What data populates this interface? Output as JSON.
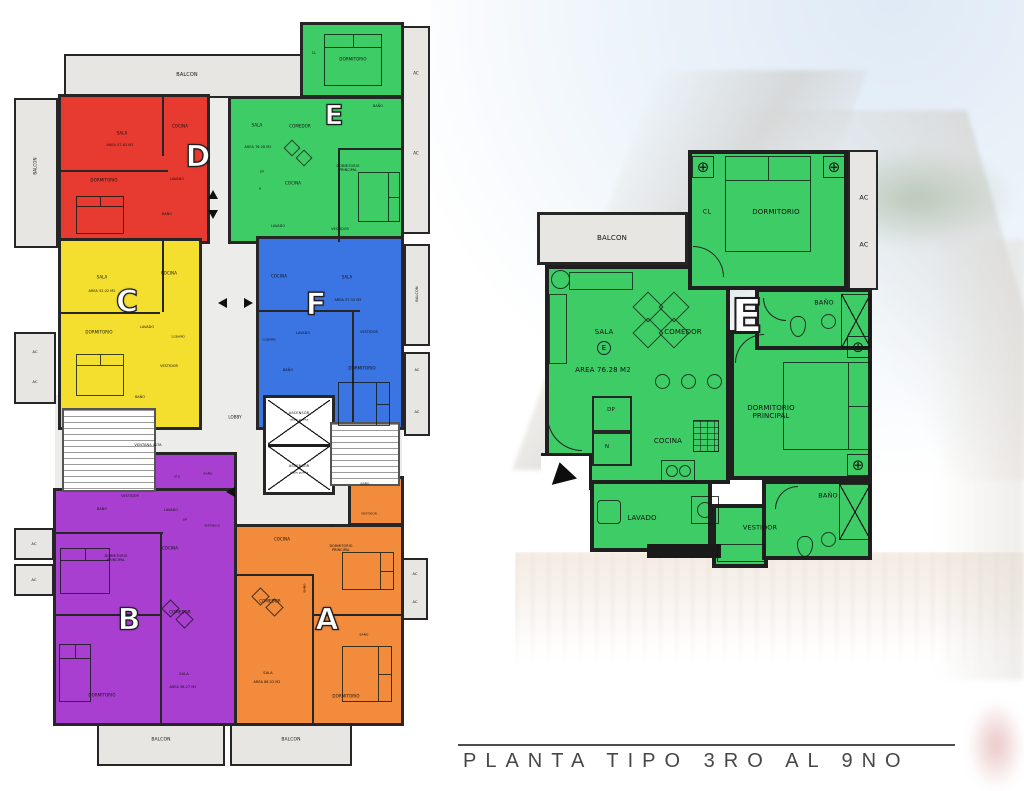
{
  "title_block": {
    "text": "PLANTA TIPO 3RO AL 9NO"
  },
  "colors": {
    "unit_a": "#F28B3B",
    "unit_b": "#A93FD1",
    "unit_c": "#F4DF2E",
    "unit_d": "#E73B31",
    "unit_e": "#3ECC66",
    "unit_f": "#3B74E3"
  },
  "units": [
    {
      "letter": "A",
      "area_label": "AREA 86.03 M2",
      "color": "#F28B3B"
    },
    {
      "letter": "B",
      "area_label": "AREA 98.27 M2",
      "color": "#A93FD1"
    },
    {
      "letter": "C",
      "area_label": "AREA 52.02 M2",
      "color": "#F4DF2E"
    },
    {
      "letter": "D",
      "area_label": "AREA 57.83 M2",
      "color": "#E73B31"
    },
    {
      "letter": "E",
      "area_label": "AREA 76.28 M2",
      "color": "#3ECC66"
    },
    {
      "letter": "F",
      "area_label": "AREA 57.33 M2",
      "color": "#3B74E3"
    }
  ],
  "overview_plan": {
    "letters": [
      {
        "t": "D",
        "x": 186,
        "y": 143,
        "fs": 30,
        "name": "unit-letter-d"
      },
      {
        "t": "E",
        "x": 322,
        "y": 101,
        "fs": 28,
        "name": "unit-letter-e"
      },
      {
        "t": "C",
        "x": 115,
        "y": 288,
        "fs": 30,
        "name": "unit-letter-c"
      },
      {
        "t": "F",
        "x": 304,
        "y": 291,
        "fs": 30,
        "name": "unit-letter-f"
      },
      {
        "t": "B",
        "x": 117,
        "y": 606,
        "fs": 30,
        "name": "unit-letter-b"
      },
      {
        "t": "A",
        "x": 315,
        "y": 606,
        "fs": 30,
        "name": "unit-letter-a"
      }
    ],
    "labels": [
      {
        "t": "BALCON",
        "x": 175,
        "y": 62,
        "fs": 5
      },
      {
        "t": "AC",
        "x": 404,
        "y": 60,
        "fs": 4
      },
      {
        "t": "AC",
        "x": 404,
        "y": 140,
        "fs": 4
      },
      {
        "t": "BALCON",
        "x": 24,
        "y": 152,
        "fs": 4,
        "rot": -90
      },
      {
        "t": "AC",
        "x": 23,
        "y": 338,
        "fs": 3.8
      },
      {
        "t": "AC",
        "x": 23,
        "y": 368,
        "fs": 3.8
      },
      {
        "t": "BALCON",
        "x": 405,
        "y": 280,
        "fs": 3.6,
        "rot": -90
      },
      {
        "t": "AC",
        "x": 405,
        "y": 356,
        "fs": 3.6
      },
      {
        "t": "AC",
        "x": 405,
        "y": 398,
        "fs": 3.6
      },
      {
        "t": "AC",
        "x": 22,
        "y": 530,
        "fs": 3.8
      },
      {
        "t": "AC",
        "x": 22,
        "y": 566,
        "fs": 3.8
      },
      {
        "t": "AC",
        "x": 403,
        "y": 560,
        "fs": 3.6
      },
      {
        "t": "AC",
        "x": 403,
        "y": 588,
        "fs": 3.6
      },
      {
        "t": "LOBBY",
        "x": 223,
        "y": 404,
        "fs": 4
      },
      {
        "t": "VENTANA ALTA",
        "x": 136,
        "y": 431,
        "fs": 3.6
      },
      {
        "t": "ASCENSOR",
        "x": 287,
        "y": 399,
        "fs": 3.6
      },
      {
        "t": "doble puerta",
        "x": 287,
        "y": 406,
        "fs": 2.8
      },
      {
        "t": "ASCENSOR",
        "x": 287,
        "y": 452,
        "fs": 3.6
      },
      {
        "t": "doble puerta",
        "x": 287,
        "y": 459,
        "fs": 2.8
      },
      {
        "t": "BALCON",
        "x": 149,
        "y": 726,
        "fs": 4.5
      },
      {
        "t": "BALCON",
        "x": 279,
        "y": 726,
        "fs": 4.5
      },
      {
        "t": "SALA",
        "x": 110,
        "y": 120,
        "fs": 4
      },
      {
        "t": "AREA 57.83 M2",
        "x": 108,
        "y": 132,
        "fs": 3.4
      },
      {
        "t": "COCINA",
        "x": 168,
        "y": 113,
        "fs": 4
      },
      {
        "t": "DORMITORIO",
        "x": 92,
        "y": 167,
        "fs": 4
      },
      {
        "t": "LAVADO",
        "x": 165,
        "y": 166,
        "fs": 3.4
      },
      {
        "t": "BAÑO",
        "x": 155,
        "y": 201,
        "fs": 3.4
      },
      {
        "t": "DORMITORIO",
        "x": 341,
        "y": 46,
        "fs": 4
      },
      {
        "t": "CL",
        "x": 302,
        "y": 40,
        "fs": 3.4
      },
      {
        "t": "SALA",
        "x": 245,
        "y": 112,
        "fs": 4
      },
      {
        "t": "COMEDOR",
        "x": 288,
        "y": 113,
        "fs": 4
      },
      {
        "t": "AREA 76.28 M2",
        "x": 246,
        "y": 134,
        "fs": 3.4
      },
      {
        "t": "BAÑO",
        "x": 366,
        "y": 93,
        "fs": 3.4
      },
      {
        "t": "DORMITORIO\nPRINCIPAL",
        "x": 336,
        "y": 155,
        "fs": 3.4
      },
      {
        "t": "COCINA",
        "x": 281,
        "y": 170,
        "fs": 4
      },
      {
        "t": "DP",
        "x": 250,
        "y": 158,
        "fs": 3
      },
      {
        "t": "N",
        "x": 248,
        "y": 175,
        "fs": 3
      },
      {
        "t": "LAVADO",
        "x": 266,
        "y": 213,
        "fs": 3.4
      },
      {
        "t": "VESTIDOR",
        "x": 328,
        "y": 216,
        "fs": 3.4
      },
      {
        "t": "SALA",
        "x": 90,
        "y": 264,
        "fs": 4
      },
      {
        "t": "AREA 52.02 M2",
        "x": 90,
        "y": 278,
        "fs": 3.4
      },
      {
        "t": "COCINA",
        "x": 157,
        "y": 260,
        "fs": 4
      },
      {
        "t": "DORMITORIO",
        "x": 87,
        "y": 319,
        "fs": 4
      },
      {
        "t": "LAVADO",
        "x": 135,
        "y": 314,
        "fs": 3.4
      },
      {
        "t": "1/2BAÑO",
        "x": 166,
        "y": 323,
        "fs": 3
      },
      {
        "t": "VESTIDOR",
        "x": 157,
        "y": 353,
        "fs": 3.4
      },
      {
        "t": "BAÑO",
        "x": 128,
        "y": 384,
        "fs": 3.4
      },
      {
        "t": "COCINA",
        "x": 267,
        "y": 263,
        "fs": 4
      },
      {
        "t": "SALA",
        "x": 335,
        "y": 264,
        "fs": 4
      },
      {
        "t": "AREA 57.33 M2",
        "x": 336,
        "y": 287,
        "fs": 3.4
      },
      {
        "t": "LAVADO",
        "x": 291,
        "y": 320,
        "fs": 3.4
      },
      {
        "t": "1/2BAÑO",
        "x": 257,
        "y": 326,
        "fs": 3
      },
      {
        "t": "BAÑO",
        "x": 276,
        "y": 357,
        "fs": 3.4
      },
      {
        "t": "VESTIDOR",
        "x": 357,
        "y": 319,
        "fs": 3.4
      },
      {
        "t": "DORMITORIO",
        "x": 350,
        "y": 355,
        "fs": 4
      },
      {
        "t": "VESTIDOR",
        "x": 118,
        "y": 483,
        "fs": 3.4
      },
      {
        "t": "BAÑO",
        "x": 90,
        "y": 496,
        "fs": 3.4
      },
      {
        "t": "UTIL",
        "x": 165,
        "y": 463,
        "fs": 3
      },
      {
        "t": "BAÑO",
        "x": 196,
        "y": 460,
        "fs": 3
      },
      {
        "t": "LAVADO",
        "x": 159,
        "y": 497,
        "fs": 3.4
      },
      {
        "t": "DP",
        "x": 173,
        "y": 506,
        "fs": 3
      },
      {
        "t": "VESTIBULO",
        "x": 200,
        "y": 512,
        "fs": 2.8
      },
      {
        "t": "COCINA",
        "x": 158,
        "y": 535,
        "fs": 4
      },
      {
        "t": "DORMITORIO\nPRINCIPAL",
        "x": 104,
        "y": 545,
        "fs": 3.4
      },
      {
        "t": "COMEDOR",
        "x": 168,
        "y": 599,
        "fs": 4
      },
      {
        "t": "SALA",
        "x": 172,
        "y": 660,
        "fs": 3.6
      },
      {
        "t": "AREA 98.27 M2",
        "x": 171,
        "y": 674,
        "fs": 3.4
      },
      {
        "t": "DORMITORIO",
        "x": 90,
        "y": 682,
        "fs": 4
      },
      {
        "t": "BAÑO",
        "x": 353,
        "y": 470,
        "fs": 3
      },
      {
        "t": "VESTIDOR",
        "x": 357,
        "y": 500,
        "fs": 3
      },
      {
        "t": "COCINA",
        "x": 270,
        "y": 526,
        "fs": 4
      },
      {
        "t": "CL",
        "x": 320,
        "y": 512,
        "fs": 3
      },
      {
        "t": "DORMITORIO\nPRINCIPAL",
        "x": 329,
        "y": 535,
        "fs": 3.4
      },
      {
        "t": "BAÑO",
        "x": 293,
        "y": 574,
        "fs": 3,
        "rot": -90
      },
      {
        "t": "COMEDOR",
        "x": 258,
        "y": 588,
        "fs": 4
      },
      {
        "t": "BAÑO",
        "x": 352,
        "y": 621,
        "fs": 3
      },
      {
        "t": "SALA",
        "x": 256,
        "y": 659,
        "fs": 3.6
      },
      {
        "t": "AREA 86.03 M2",
        "x": 255,
        "y": 669,
        "fs": 3.4
      },
      {
        "t": "DORMITORIO",
        "x": 334,
        "y": 683,
        "fs": 4
      }
    ]
  },
  "detail_plan": {
    "unit_letter": {
      "t": "E",
      "x": 212,
      "y": 168,
      "fs": 46,
      "name": "unit-letter-e-large"
    },
    "sala_mark": "E",
    "fixture_glyph": "⊕",
    "area_label": "AREA 76.28 M2",
    "labels": [
      {
        "t": "BALCON",
        "x": 77,
        "y": 90,
        "fs": 7
      },
      {
        "t": "CL",
        "x": 172,
        "y": 64,
        "fs": 6.5
      },
      {
        "t": "DORMITORIO",
        "x": 241,
        "y": 64,
        "fs": 7
      },
      {
        "t": "AC",
        "x": 329,
        "y": 50,
        "fs": 6.5
      },
      {
        "t": "AC",
        "x": 329,
        "y": 97,
        "fs": 6.5
      },
      {
        "t": "SALA",
        "x": 69,
        "y": 184,
        "fs": 7
      },
      {
        "t": "COMEDOR",
        "x": 148,
        "y": 184,
        "fs": 7
      },
      {
        "t": "AREA 76.28 M2",
        "x": 68,
        "y": 222,
        "fs": 7
      },
      {
        "t": "BAÑO",
        "x": 289,
        "y": 155,
        "fs": 6.5
      },
      {
        "t": "DORMITORIO\nPRINCIPAL",
        "x": 236,
        "y": 264,
        "fs": 7
      },
      {
        "t": "DP",
        "x": 76,
        "y": 262,
        "fs": 5.5
      },
      {
        "t": "N",
        "x": 72,
        "y": 299,
        "fs": 5.5
      },
      {
        "t": "COCINA",
        "x": 133,
        "y": 293,
        "fs": 7
      },
      {
        "t": "LAVADO",
        "x": 107,
        "y": 370,
        "fs": 7
      },
      {
        "t": "VESTIDOR",
        "x": 225,
        "y": 380,
        "fs": 6.5
      },
      {
        "t": "BAÑO",
        "x": 293,
        "y": 348,
        "fs": 6.5
      }
    ]
  }
}
